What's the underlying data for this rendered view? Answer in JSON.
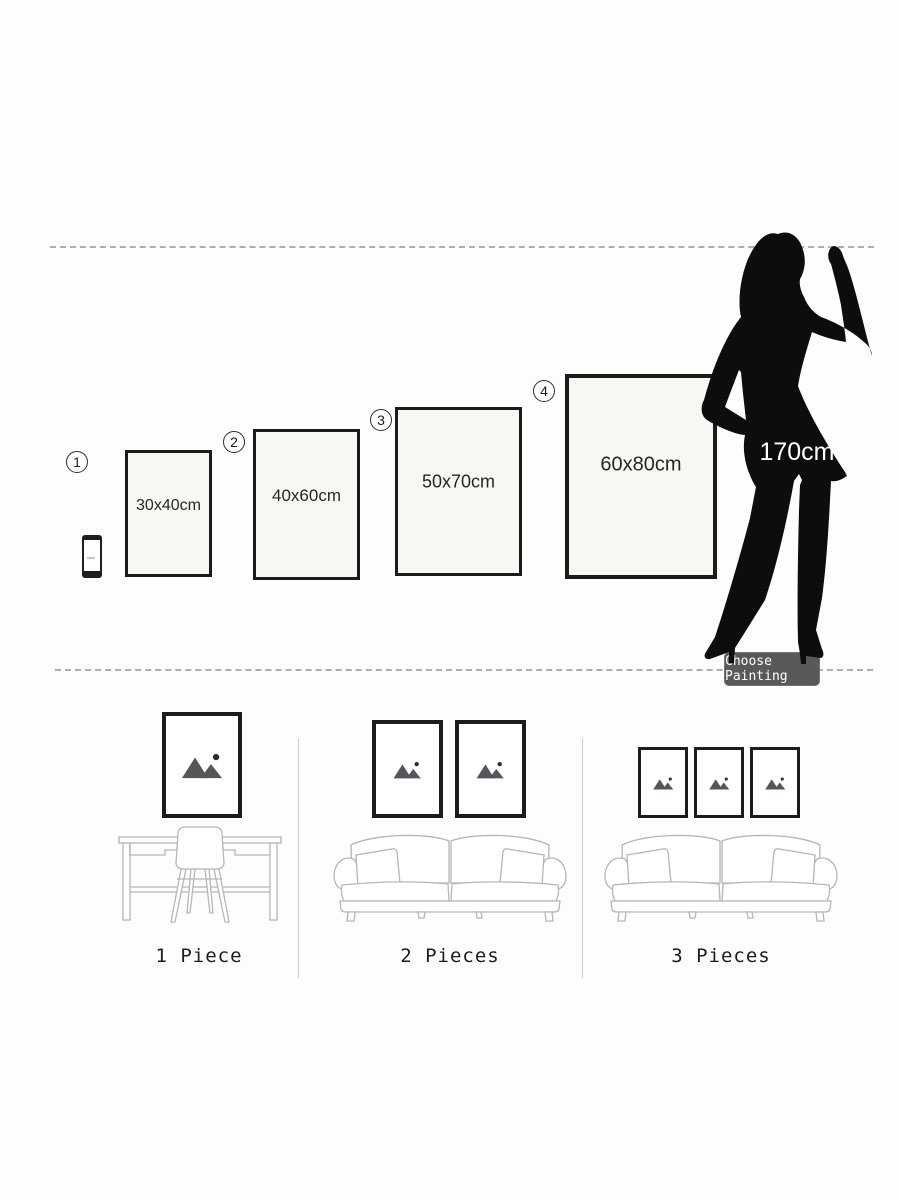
{
  "size_guide": {
    "options": [
      {
        "number": "1",
        "size": "30x40cm"
      },
      {
        "number": "2",
        "size": "40x60cm"
      },
      {
        "number": "3",
        "size": "50x70cm"
      },
      {
        "number": "4",
        "size": "60x80cm"
      }
    ],
    "reference_height": "170cm",
    "choose_button": "Choose Painting"
  },
  "placement_guide": {
    "scenes": [
      {
        "label": "1 Piece",
        "frame_count": 1,
        "furniture": "desk-and-chair"
      },
      {
        "label": "2 Pieces",
        "frame_count": 2,
        "furniture": "sofa"
      },
      {
        "label": "3 Pieces",
        "frame_count": 3,
        "furniture": "sofa"
      }
    ]
  },
  "icons": {
    "phone": "smartphone-icon",
    "figure": "woman-silhouette",
    "placeholder": "image-placeholder-icon"
  },
  "colors": {
    "background": "#fdfdfb",
    "frame_border": "#1b1b1b",
    "frame_fill": "#f8f7f4",
    "dashed_line": "#aeaeae",
    "silhouette": "#0d0d0d",
    "button_bg": "#59595b",
    "button_text": "#ffffff",
    "sketch_stroke": "#b6b6b6",
    "placeholder_gray": "#54565a",
    "text_dark": "#262626"
  }
}
